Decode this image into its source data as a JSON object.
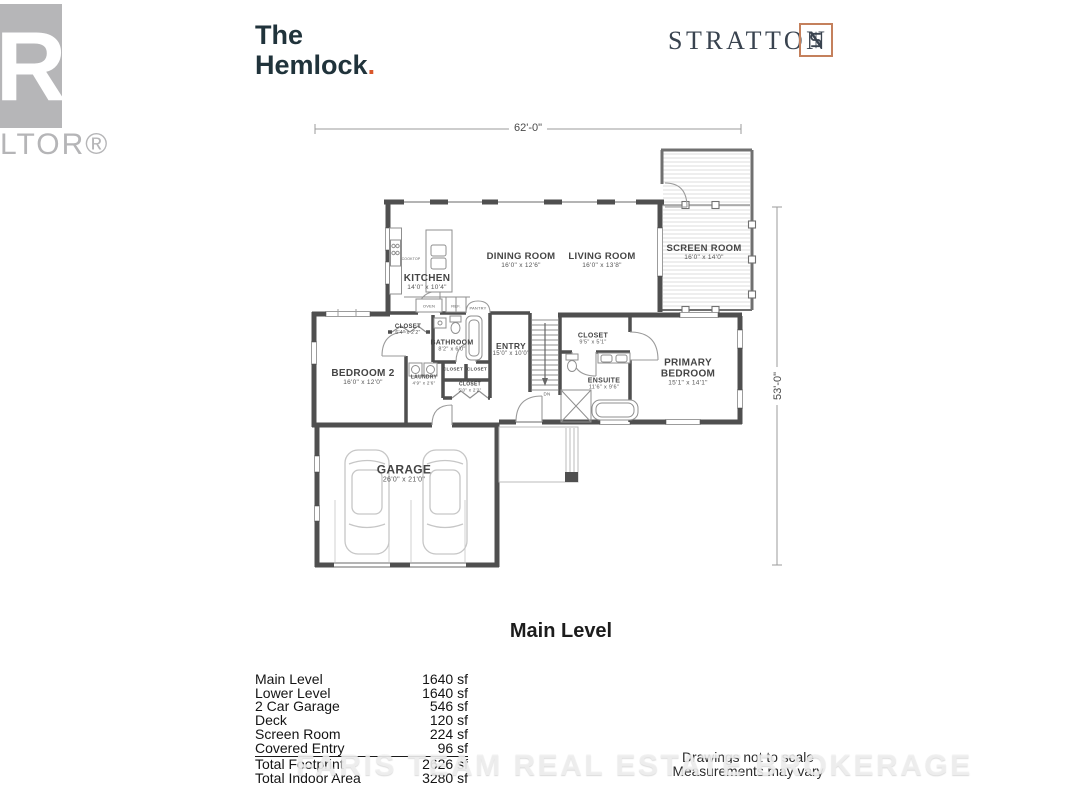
{
  "branding": {
    "realtor": {
      "letter": "R",
      "partial_text": "LTOR®"
    },
    "title": {
      "line1": "The",
      "line2": "Hemlock",
      "period": "."
    },
    "builder": {
      "name": "STRATTON",
      "monogram": "S"
    }
  },
  "plan": {
    "dim_width": "62'-0\"",
    "dim_height": "53'-0\"",
    "level_label": "Main Level",
    "rooms": {
      "kitchen": {
        "name": "KITCHEN",
        "dims": "14'0\" x 10'4\""
      },
      "dining": {
        "name": "DINING ROOM",
        "dims": "16'0\" x 12'6\""
      },
      "living": {
        "name": "LIVING ROOM",
        "dims": "16'0\" x 13'8\""
      },
      "screen": {
        "name": "SCREEN ROOM",
        "dims": "16'0\" x 14'0\""
      },
      "entry": {
        "name": "ENTRY",
        "dims": "15'0\" x 10'0\""
      },
      "bedroom2": {
        "name": "BEDROOM 2",
        "dims": "16'0\" x 12'0\""
      },
      "bathroom": {
        "name": "BATHROOM",
        "dims": "8'2\" x 6'0\""
      },
      "closet_bed2": {
        "name": "CLOSET",
        "dims": "6'4\" x 2'2\""
      },
      "laundry": {
        "name": "LAUNDRY",
        "dims": "4'9\" x 2'6\""
      },
      "closet_small_a": {
        "name": "CLOSET"
      },
      "closet_small_b": {
        "name": "CLOSET"
      },
      "closet_entry": {
        "name": "CLOSET",
        "dims": "5'0\" x 2'2\""
      },
      "closet_primary": {
        "name": "CLOSET",
        "dims": "9'5\" x 5'1\""
      },
      "ensuite": {
        "name": "ENSUITE",
        "dims": "11'6\" x 9'6\""
      },
      "primary": {
        "name_line1": "PRIMARY",
        "name_line2": "BEDROOM",
        "dims": "15'1\" x 14'1\""
      },
      "garage": {
        "name": "GARAGE",
        "dims": "26'0\" x 21'0\""
      }
    },
    "fixtures": {
      "cooktop": "COOKTOP",
      "oven": "OVEN",
      "fridge": "REF.",
      "pantry": "PANTRY",
      "stairs_dn": "DN"
    }
  },
  "areas": {
    "rows": [
      {
        "label": "Main Level",
        "value": "1640 sf"
      },
      {
        "label": "Lower Level",
        "value": "1640 sf"
      },
      {
        "label": "2 Car Garage",
        "value": "546 sf"
      },
      {
        "label": "Deck",
        "value": "120 sf"
      },
      {
        "label": "Screen Room",
        "value": "224 sf"
      },
      {
        "label": "Covered Entry",
        "value": "96 sf"
      }
    ],
    "totals": [
      {
        "label": "Total Footprint",
        "value": "2626 sf"
      },
      {
        "label": "Total Indoor Area",
        "value": "3280 sf"
      }
    ]
  },
  "footer": {
    "line1": "Drawings not to scale",
    "line2": "Measurements may vary"
  },
  "watermark": "FARIS TEAM REAL ESTATE BROKERAGE",
  "colors": {
    "accent": "#D9572B",
    "wall": "#4F4F4F",
    "title_text": "#20333B",
    "stratton_text": "#39434F",
    "realtor_gray": "#B6B6B8"
  }
}
